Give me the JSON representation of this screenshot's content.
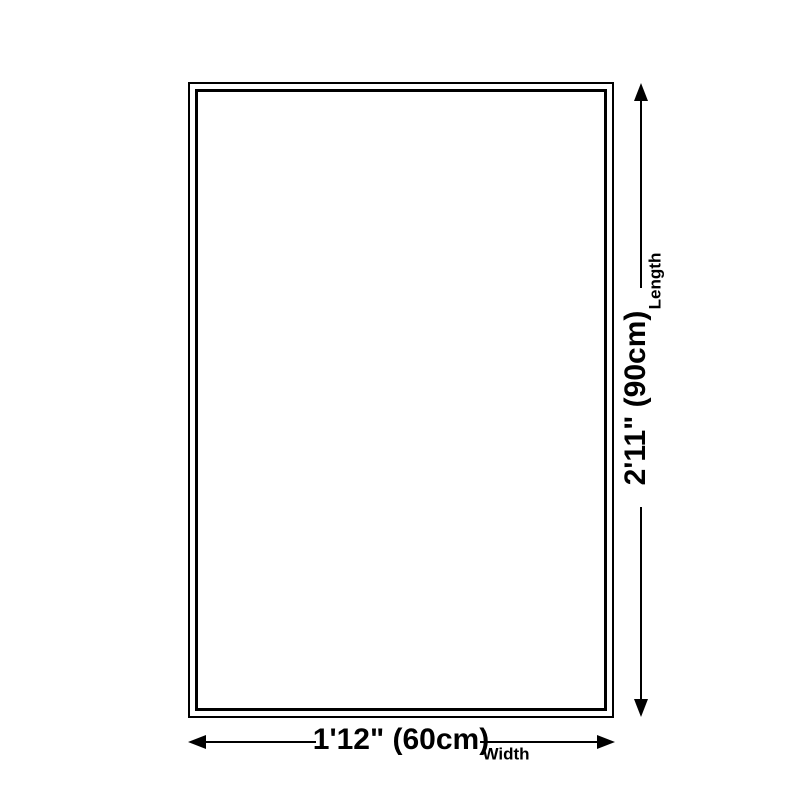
{
  "dimensions": {
    "length": {
      "value": "2'11\" (90cm)",
      "label": "Length"
    },
    "width": {
      "value": "1'12\" (60cm)",
      "label": "Width"
    }
  },
  "colors": {
    "line": "#000000",
    "background": "#ffffff"
  }
}
